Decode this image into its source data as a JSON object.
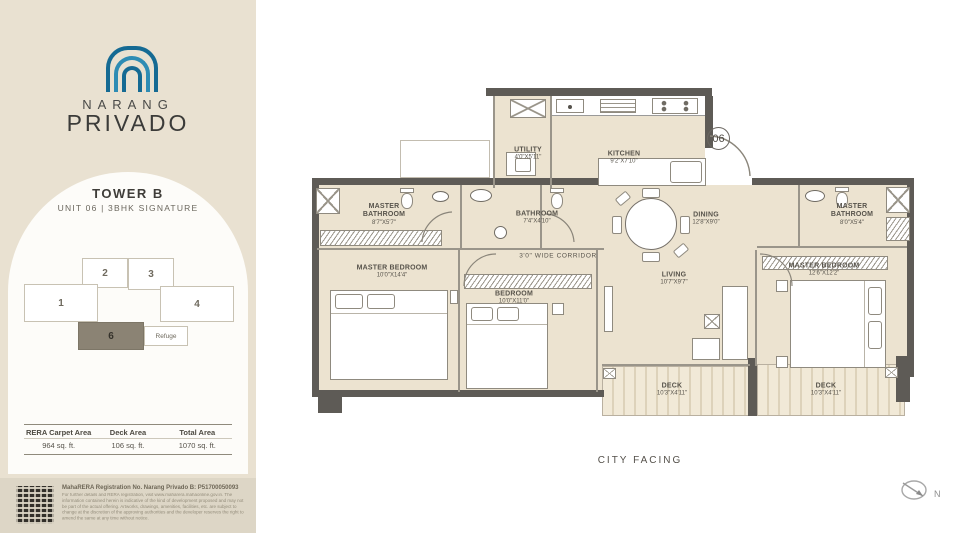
{
  "colors": {
    "sidebar_beige": "#e9e1d1",
    "footer_beige": "#ddd6c6",
    "card_white": "#fdfcf9",
    "logo_blue_dark": "#156a93",
    "logo_blue_light": "#2e8cb4",
    "wall_gray": "#5e5b56",
    "room_beige": "#ece3d0",
    "keyplan_highlight": "#8b8374"
  },
  "sidebar": {
    "brand": {
      "name_top": "NARANG",
      "name_bottom": "PRIVADO"
    },
    "tower": {
      "title": "TOWER B",
      "subtitle": "UNIT 06  |  3BHK SIGNATURE"
    },
    "keyplan": {
      "units": [
        "1",
        "2",
        "3",
        "4"
      ],
      "highlighted_unit": "6",
      "refuge_label": "Refuge"
    },
    "area_table": {
      "headers": [
        "RERA Carpet Area",
        "Deck Area",
        "Total Area"
      ],
      "values": [
        "964 sq. ft.",
        "106 sq. ft.",
        "1070 sq. ft."
      ]
    },
    "footer": {
      "rera_line": "MahaRERA Registration No. Narang Privado B: P51700050093",
      "disclaimer": "For further details and RERA registration, visit www.maharera.mahaonline.gov.in. The information contained herein is indicative of the kind of development proposed and may not be part of the actual offering. Artworks, drawings, amenities, facilities, etc. are subject to change at the discretion of the approving authorities and the developer reserves the right to amend the same at any time without notice."
    }
  },
  "plan": {
    "unit_number": "06",
    "corridor_label": "3'0\" WIDE CORRIDOR",
    "facing_label": "CITY FACING",
    "compass_label": "N",
    "rooms": {
      "utility": {
        "name": "UTILITY",
        "dims": "4'0\"X5'11\""
      },
      "kitchen": {
        "name": "KITCHEN",
        "dims": "9'2\"X7'10\""
      },
      "master_bathroom_left": {
        "name": "MASTER BATHROOM",
        "dims": "8'7\"X5'7\""
      },
      "bathroom": {
        "name": "BATHROOM",
        "dims": "7'4\"X4'10\""
      },
      "master_bathroom_right": {
        "name": "MASTER BATHROOM",
        "dims": "8'0\"X5'4\""
      },
      "dining": {
        "name": "DINING",
        "dims": "12'8\"X9'0\""
      },
      "living": {
        "name": "LIVING",
        "dims": "10'7\"X9'7\""
      },
      "master_bedroom_left": {
        "name": "MASTER BEDROOM",
        "dims": "10'0\"X14'4\""
      },
      "bedroom": {
        "name": "BEDROOM",
        "dims": "10'0\"X11'0\""
      },
      "master_bedroom_right": {
        "name": "MASTER BEDROOM",
        "dims": "12'6\"X12'2\""
      },
      "deck_left": {
        "name": "DECK",
        "dims": "10'3\"X4'11\""
      },
      "deck_right": {
        "name": "DECK",
        "dims": "10'3\"X4'11\""
      }
    }
  }
}
